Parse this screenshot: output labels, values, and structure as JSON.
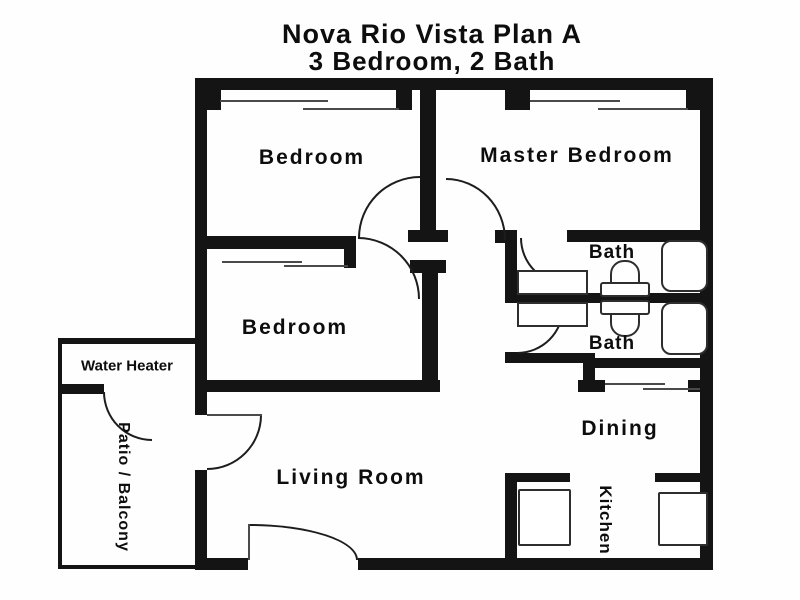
{
  "title": {
    "line1": "Nova Rio Vista Plan A",
    "line2": "3 Bedroom, 2 Bath"
  },
  "rooms": {
    "bedroom_top_left": "Bedroom",
    "master_bedroom": "Master Bedroom",
    "bedroom_mid_left": "Bedroom",
    "bath_top": "Bath",
    "bath_bottom": "Bath",
    "water_heater": "Water Heater",
    "patio": "Patio / Balcony",
    "living_room": "Living Room",
    "dining": "Dining",
    "kitchen": "Kitchen"
  },
  "colors": {
    "wall": "#141414",
    "background": "#fefefe",
    "fixture_outline": "#2e2e2e",
    "text": "#0d0d0d"
  }
}
